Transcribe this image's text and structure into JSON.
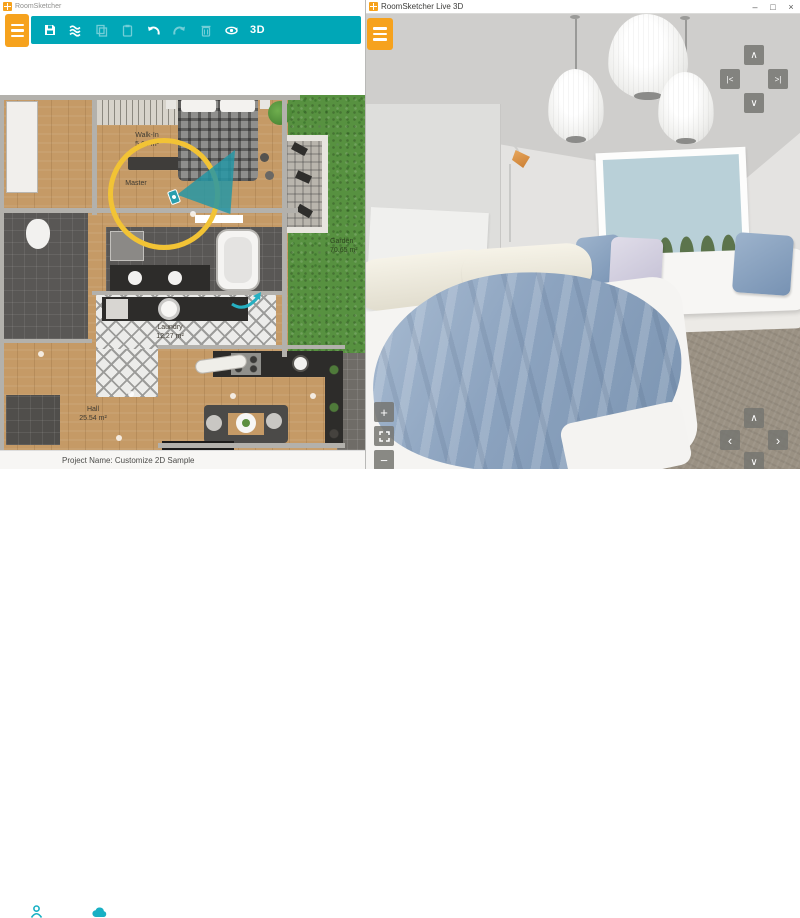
{
  "left_window": {
    "title": "RoomSketcher",
    "toolbar": {
      "threed_label": "3D",
      "icons": [
        "menu",
        "save",
        "sketch-mode",
        "copy",
        "paste",
        "undo",
        "redo",
        "delete",
        "rotate-view"
      ]
    },
    "floorplan": {
      "rooms": {
        "walkin": {
          "name": "Walk-In",
          "area": "5.66 m²"
        },
        "master": {
          "name": "Master"
        },
        "garden": {
          "name": "Garden",
          "area": "70.65 m²"
        },
        "laundry": {
          "name": "Laundry",
          "area": "12.27 m²"
        },
        "hall": {
          "name": "Hall",
          "area": "25.54 m²"
        }
      }
    },
    "statusbar": {
      "project": "Project Name: Customize 2D Sample"
    }
  },
  "right_window": {
    "title": "RoomSketcher Live 3D",
    "window_controls": {
      "minimize": "–",
      "maximize": "□",
      "close": "×"
    },
    "viewport_controls": {
      "nav_top": {
        "up": "∧",
        "left": "|<",
        "right": ">|",
        "down": "∨"
      },
      "zoom": {
        "in": "+",
        "out": "−"
      },
      "nav_bottom": {
        "up": "∧",
        "left": "‹",
        "right": "›",
        "down": "∨"
      }
    }
  },
  "colors": {
    "brand_teal": "#00a7b7",
    "brand_orange": "#f6a21d",
    "highlight_yellow": "#f2c335",
    "camera_teal": "#2a9fae"
  }
}
